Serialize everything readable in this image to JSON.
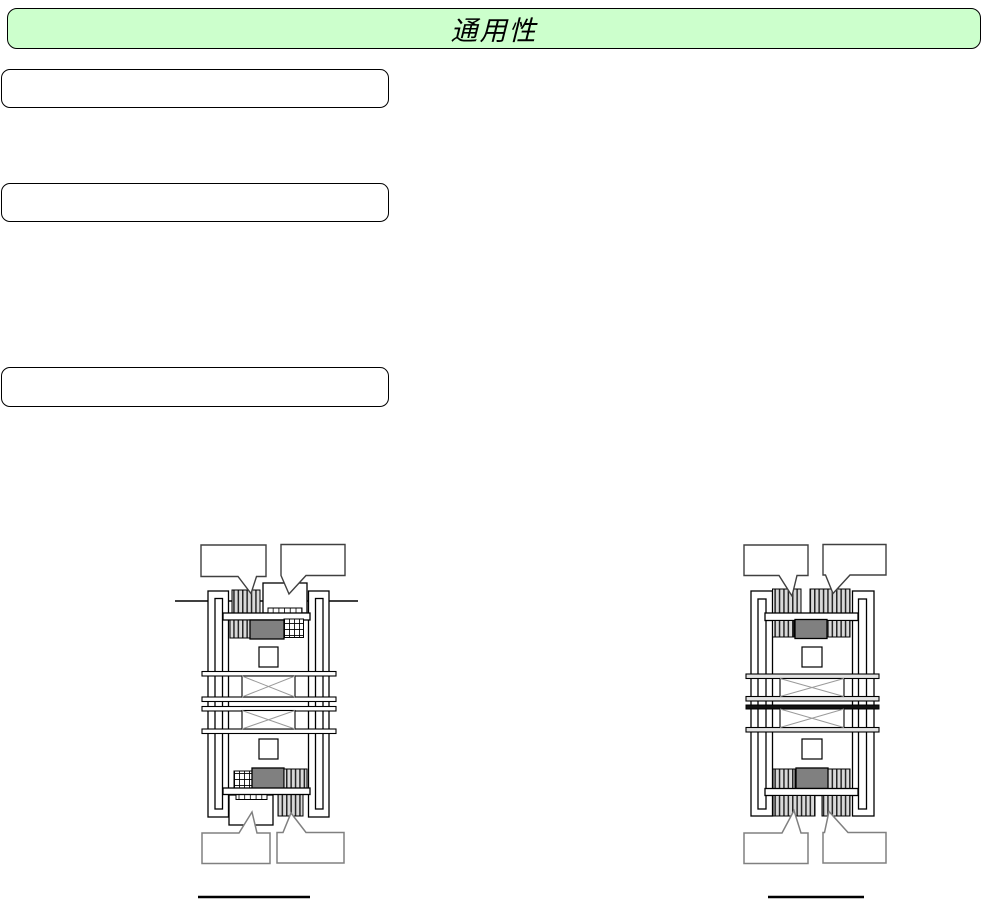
{
  "header": {
    "title": "通用性"
  },
  "text_boxes": [
    {
      "label": ""
    },
    {
      "label": ""
    },
    {
      "label": ""
    }
  ],
  "left_diagram": {
    "name": "cross-section-with-ground-line",
    "callouts": {
      "top_left": "",
      "top_right": "",
      "bottom_left": "",
      "bottom_right": ""
    },
    "caption_underline": true
  },
  "right_diagram": {
    "name": "cross-section-symmetric",
    "callouts": {
      "top_left": "",
      "top_right": "",
      "bottom_left": "",
      "bottom_right": ""
    },
    "caption_underline": true
  },
  "colors": {
    "banner_fill": "#ccffcc",
    "banner_border": "#000000",
    "gray_block": "#808080",
    "hatch_background": "#d9d9d9",
    "hatch_stripe": "#262626",
    "bar_fill_right": "#e4e4e4",
    "black_bar": "#111111",
    "outline": "#000000",
    "callout_border_top": "#404040",
    "callout_border_bottom": "#808080",
    "x_brace_line": "#9a9a9a"
  }
}
